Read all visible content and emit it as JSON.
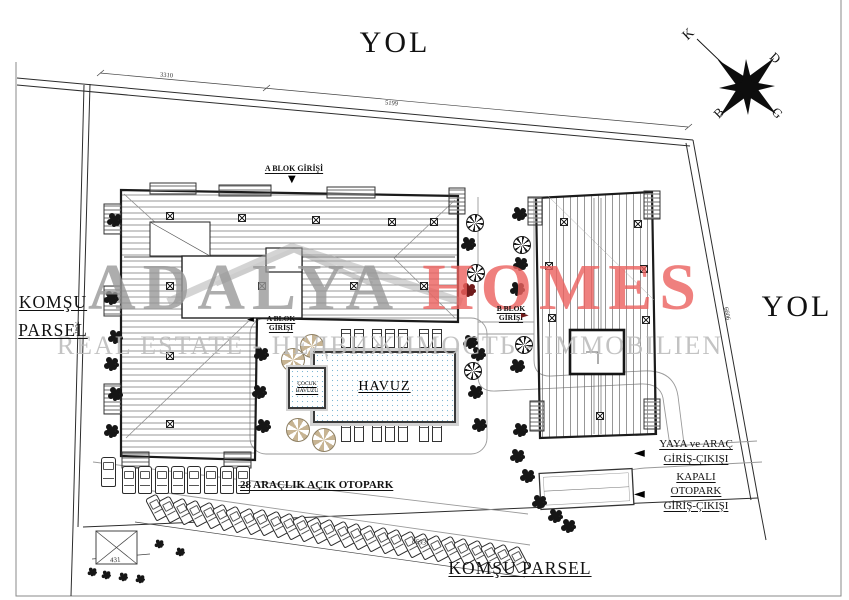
{
  "roads": {
    "top": "YOL",
    "right": "YOL"
  },
  "neighbors": {
    "left_line1": "KOMŞU",
    "left_line2": "PARSEL",
    "bottom": "KOMŞU PARSEL"
  },
  "compass": {
    "north": "K",
    "east": "D",
    "south": "G",
    "west": "B"
  },
  "watermark": {
    "brand": "ADALYA",
    "brand2": "HOMES",
    "tagline": "REAL ESTATE - НЕДВИЖИМОСТЬ - IMMOBILIEN",
    "brand_color": "#999999",
    "brand2_color": "#ec615e",
    "tagline_color": "#bdbdbd"
  },
  "entrances": {
    "a_top": "A BLOK GİRİŞİ",
    "a_side1": "A BLOK",
    "a_side2": "GİRİŞİ",
    "b1": "B BLOK",
    "b2": "GİRİŞİ",
    "pedestrian1": "YAYA ve ARAÇ",
    "pedestrian2": "GİRİŞ-ÇIKIŞI",
    "covered1": "KAPALI",
    "covered2": "OTOPARK",
    "covered3": "GİRİŞ-ÇIKIŞI",
    "arrow_down": "▼",
    "arrow_left": "◄",
    "arrow_right": "►"
  },
  "pool": {
    "main": "HAVUZ",
    "kids1": "ÇOCUK",
    "kids2": "HAVUZU"
  },
  "parking": {
    "open_label": "28 ARAÇLIK AÇIK OTOPARK",
    "open_count": 28
  },
  "dimensions": {
    "top_left": "3310",
    "top_right": "5199",
    "left": "7041",
    "right": "6606",
    "bottom": "8693",
    "service": "431"
  }
}
